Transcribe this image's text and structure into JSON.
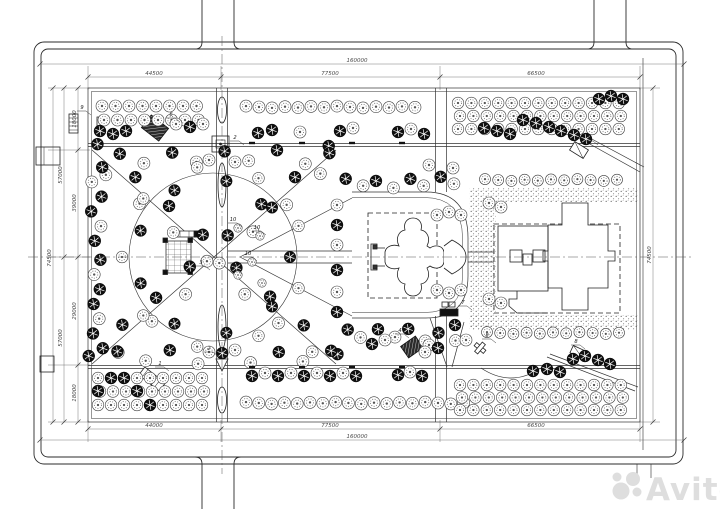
{
  "drawing": {
    "kind": "landscape-master-plan",
    "colors": {
      "line": "#2b2b2b",
      "dim": "#4a4a4a",
      "paper": "#ffffff",
      "watermark": "#dedede",
      "tree_dark": "#0f0f0f"
    }
  },
  "dims": {
    "top_total": "160000",
    "top_left": "44500",
    "top_mid": "77500",
    "top_right": "66500",
    "bottom_left": "44000",
    "bottom_mid": "77500",
    "bottom_right": "66500",
    "bottom_total": "160000",
    "left_total": "74500",
    "left_chain_a": "57000",
    "left_chain_b": "57000",
    "left_seg1": "18000",
    "left_seg2": "39000",
    "left_seg3": "29000",
    "left_seg4": "18000",
    "right_total": "74500"
  },
  "watermark": {
    "text": "Avito"
  },
  "callouts": [
    {
      "n": "9",
      "x": 82,
      "y": 109
    },
    {
      "n": "6",
      "x": 171,
      "y": 116
    },
    {
      "n": "2",
      "x": 235,
      "y": 139
    },
    {
      "n": "10",
      "x": 233,
      "y": 221
    },
    {
      "n": "10",
      "x": 257,
      "y": 229
    },
    {
      "n": "10",
      "x": 248,
      "y": 255
    },
    {
      "n": "10",
      "x": 233,
      "y": 268
    },
    {
      "n": "3",
      "x": 201,
      "y": 264
    },
    {
      "n": "1",
      "x": 160,
      "y": 365
    },
    {
      "n": "2",
      "x": 209,
      "y": 350
    },
    {
      "n": "4",
      "x": 400,
      "y": 332
    },
    {
      "n": "8",
      "x": 487,
      "y": 337
    },
    {
      "n": "7",
      "x": 463,
      "y": 304
    },
    {
      "n": "5",
      "x": 589,
      "y": 139
    },
    {
      "n": "8",
      "x": 576,
      "y": 343
    }
  ],
  "trees": {
    "rows": [
      {
        "x0": 246,
        "y": 107,
        "n": 14,
        "dx": 13,
        "r": 6,
        "s": "l"
      },
      {
        "x0": 485,
        "y": 180,
        "n": 11,
        "dx": 13.2,
        "r": 5.5,
        "s": "l"
      },
      {
        "x0": 487,
        "y": 333,
        "n": 11,
        "dx": 13.2,
        "r": 5.5,
        "s": "l"
      },
      {
        "x0": 246,
        "y": 403,
        "n": 18,
        "dx": 12.8,
        "r": 6,
        "s": "l"
      }
    ],
    "grids": [
      {
        "x0": 102,
        "y0": 106,
        "cols": 8,
        "rows": 2,
        "dx": 13.5,
        "dy": 14,
        "r": 6,
        "s": "l"
      },
      {
        "x0": 458,
        "y0": 103,
        "cols": 13,
        "rows": 3,
        "dx": 13.4,
        "dy": 13,
        "r": 5.8,
        "s": "l"
      },
      {
        "x0": 98,
        "y0": 378,
        "cols": 9,
        "rows": 3,
        "dx": 13,
        "dy": 13.5,
        "r": 5.8,
        "s": "l"
      },
      {
        "x0": 460,
        "y0": 385,
        "cols": 13,
        "rows": 3,
        "dx": 13.4,
        "dy": 12.5,
        "r": 5.8,
        "s": "l"
      }
    ],
    "alongs": [
      {
        "x1": 94,
        "y1": 152,
        "x2": 334,
        "y2": 362,
        "n": 15,
        "off": 8
      },
      {
        "x1": 94,
        "y1": 362,
        "x2": 334,
        "y2": 152,
        "n": 15,
        "off": 8
      },
      {
        "x1": 118,
        "y1": 157,
        "x2": 330,
        "y2": 157,
        "n": 9,
        "off": 5
      },
      {
        "x1": 118,
        "y1": 357,
        "x2": 330,
        "y2": 357,
        "n": 9,
        "off": 5
      },
      {
        "x1": 97,
        "y1": 166,
        "x2": 97,
        "y2": 350,
        "n": 13,
        "off": 4,
        "darkBias": true
      },
      {
        "x1": 347,
        "y1": 184,
        "x2": 455,
        "y2": 181,
        "n": 8,
        "off": 4
      },
      {
        "x1": 347,
        "y1": 333,
        "x2": 455,
        "y2": 336,
        "n": 8,
        "off": 4
      }
    ],
    "ring": {
      "cx": 213,
      "cy": 257,
      "r": 84,
      "n": 18
    },
    "scatter": [
      [
        100,
        131,
        "d"
      ],
      [
        113,
        134,
        "d"
      ],
      [
        126,
        131,
        "d"
      ],
      [
        176,
        124,
        "l"
      ],
      [
        190,
        127,
        "d"
      ],
      [
        203,
        124,
        "l"
      ],
      [
        258,
        133,
        "d"
      ],
      [
        272,
        130,
        "d"
      ],
      [
        300,
        132,
        "l"
      ],
      [
        340,
        131,
        "d"
      ],
      [
        353,
        128,
        "l"
      ],
      [
        398,
        132,
        "d"
      ],
      [
        411,
        129,
        "l"
      ],
      [
        424,
        134,
        "d"
      ],
      [
        484,
        128,
        "d"
      ],
      [
        497,
        131,
        "d"
      ],
      [
        510,
        134,
        "d"
      ],
      [
        523,
        120,
        "d"
      ],
      [
        536,
        123,
        "d"
      ],
      [
        549,
        127,
        "d"
      ],
      [
        561,
        131,
        "d"
      ],
      [
        574,
        135,
        "d"
      ],
      [
        586,
        139,
        "d"
      ],
      [
        599,
        99,
        "d"
      ],
      [
        611,
        96,
        "d"
      ],
      [
        623,
        99,
        "d"
      ],
      [
        489,
        203,
        "l"
      ],
      [
        501,
        207,
        "l"
      ],
      [
        489,
        299,
        "l"
      ],
      [
        501,
        303,
        "l"
      ],
      [
        437,
        215,
        "l"
      ],
      [
        449,
        212,
        "l"
      ],
      [
        461,
        215,
        "l"
      ],
      [
        437,
        290,
        "l"
      ],
      [
        449,
        293,
        "l"
      ],
      [
        461,
        290,
        "l"
      ],
      [
        252,
        376,
        "d"
      ],
      [
        265,
        373,
        "l"
      ],
      [
        278,
        376,
        "d"
      ],
      [
        291,
        373,
        "l"
      ],
      [
        304,
        376,
        "d"
      ],
      [
        317,
        373,
        "l"
      ],
      [
        330,
        376,
        "d"
      ],
      [
        343,
        373,
        "l"
      ],
      [
        356,
        376,
        "d"
      ],
      [
        398,
        375,
        "d"
      ],
      [
        410,
        372,
        "l"
      ],
      [
        422,
        376,
        "d"
      ],
      [
        111,
        378,
        "d"
      ],
      [
        124,
        378,
        "d"
      ],
      [
        137,
        391,
        "d"
      ],
      [
        98,
        391,
        "d"
      ],
      [
        150,
        405,
        "d"
      ],
      [
        533,
        371,
        "d"
      ],
      [
        547,
        369,
        "d"
      ],
      [
        560,
        372,
        "d"
      ],
      [
        573,
        359,
        "d"
      ],
      [
        585,
        356,
        "d"
      ],
      [
        598,
        360,
        "d"
      ],
      [
        610,
        364,
        "d"
      ],
      [
        238,
        228,
        "t"
      ],
      [
        260,
        236,
        "t"
      ],
      [
        252,
        262,
        "t"
      ],
      [
        238,
        275,
        "t"
      ],
      [
        262,
        283,
        "t"
      ],
      [
        209,
        160,
        "l"
      ],
      [
        235,
        162,
        "l"
      ],
      [
        209,
        352,
        "l"
      ],
      [
        235,
        350,
        "l"
      ],
      [
        337,
        205,
        "l"
      ],
      [
        337,
        225,
        "d"
      ],
      [
        337,
        245,
        "l"
      ],
      [
        337,
        270,
        "d"
      ],
      [
        337,
        292,
        "l"
      ],
      [
        337,
        312,
        "d"
      ],
      [
        429,
        165,
        "l"
      ],
      [
        453,
        168,
        "l"
      ],
      [
        429,
        345,
        "l"
      ],
      [
        455,
        325,
        "d"
      ],
      [
        385,
        340,
        "l"
      ],
      [
        372,
        344,
        "d"
      ],
      [
        425,
        352,
        "l"
      ],
      [
        438,
        348,
        "d"
      ],
      [
        466,
        340,
        "l"
      ]
    ]
  },
  "benches": [
    [
      252,
      143
    ],
    [
      302,
      143
    ],
    [
      352,
      143
    ],
    [
      402,
      143
    ],
    [
      252,
      367
    ],
    [
      302,
      367
    ],
    [
      352,
      367
    ],
    [
      402,
      367
    ]
  ]
}
